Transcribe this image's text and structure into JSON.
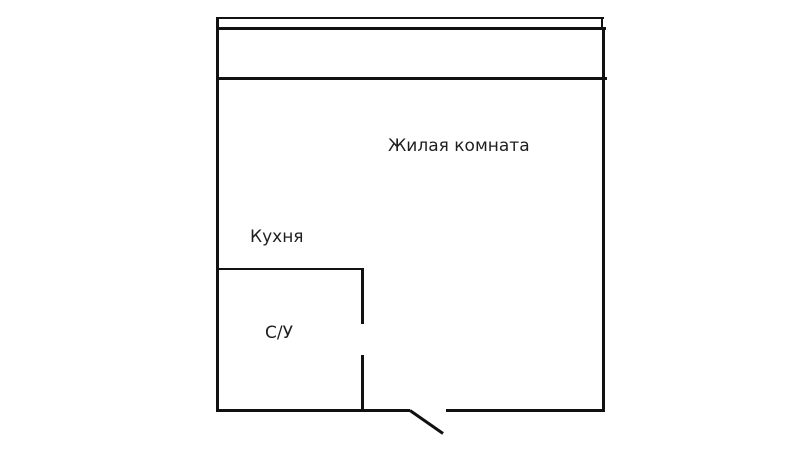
{
  "plan": {
    "name": "apartment-floor-plan",
    "rooms": {
      "living_room": {
        "label": "Жилая комната"
      },
      "kitchen": {
        "label": "Кухня"
      },
      "bathroom": {
        "label": "С/У"
      }
    }
  },
  "colors": {
    "wall": "#111111",
    "background": "#ffffff",
    "text": "#1f1f1f"
  }
}
